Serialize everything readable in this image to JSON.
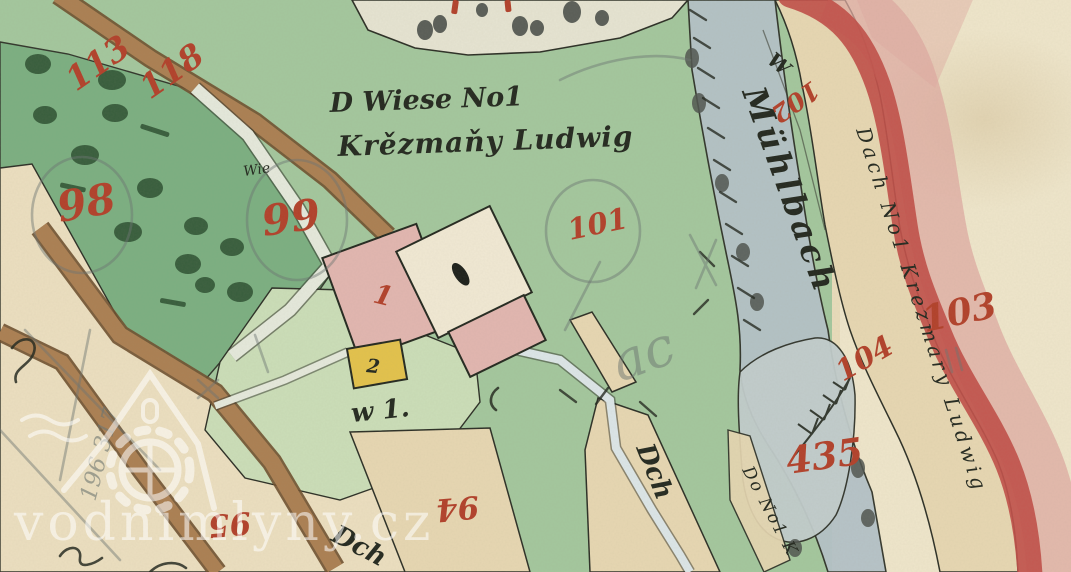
{
  "map": {
    "description": "hand-painted cadastral map sheet",
    "watermark": {
      "text": "vodnimlyny.cz"
    },
    "ink_labels": {
      "wiese_line1": "D Wiese No1",
      "wiese_line2": "Krězmaňy Ludwig",
      "wie_small": "Wie",
      "muhlbach": "Mühlbach",
      "w_letter": "W",
      "dach_strip": "Dach No1 Krezmary Ludwig",
      "do_strip": "Do No1 K",
      "dch_wedge": "Dch",
      "dch_bottom": "Dch",
      "w1": "w 1.",
      "house_no_2": "2",
      "pencil_ac": "ac",
      "pencil_survey": "196 317"
    },
    "parcel_numbers": {
      "n113": "113",
      "n118": "118",
      "n98": "98",
      "n99": "99",
      "n101": "101",
      "n102": "102",
      "n103": "103",
      "n104": "104",
      "n435": "435",
      "n94": "94",
      "n95": "95",
      "house_no_1": "1"
    },
    "palette": {
      "paper": "#e9dcbb",
      "paper_light": "#efe6cb",
      "strip_beige": "#e7d7b2",
      "field_beige": "#ecdfc0",
      "meadow_green": "#a3c79d",
      "orchard_green": "#79ae80",
      "garden_green": "#cbdeb8",
      "parcel_white": "#e6e4d2",
      "stream_blue": "#b4c2c8",
      "wet_meadow": "#c2cdcd",
      "road_brown": "#ab7f52",
      "road_edge": "#6e4f2e",
      "band_red": "#c14f49",
      "band_pink": "#dfaaa2",
      "building_pink": "#e2b6b0",
      "building_cream": "#f1e9d4",
      "building_yellow": "#e3c24b",
      "number_red": "#b2402a",
      "ink_black": "#23281f",
      "pencil_gray": "#6b7470",
      "path_white": "#e5e9dc",
      "race_blue": "#dce6e8",
      "tree_green": "#2e5233",
      "watermark_white": "#ffffff"
    }
  }
}
